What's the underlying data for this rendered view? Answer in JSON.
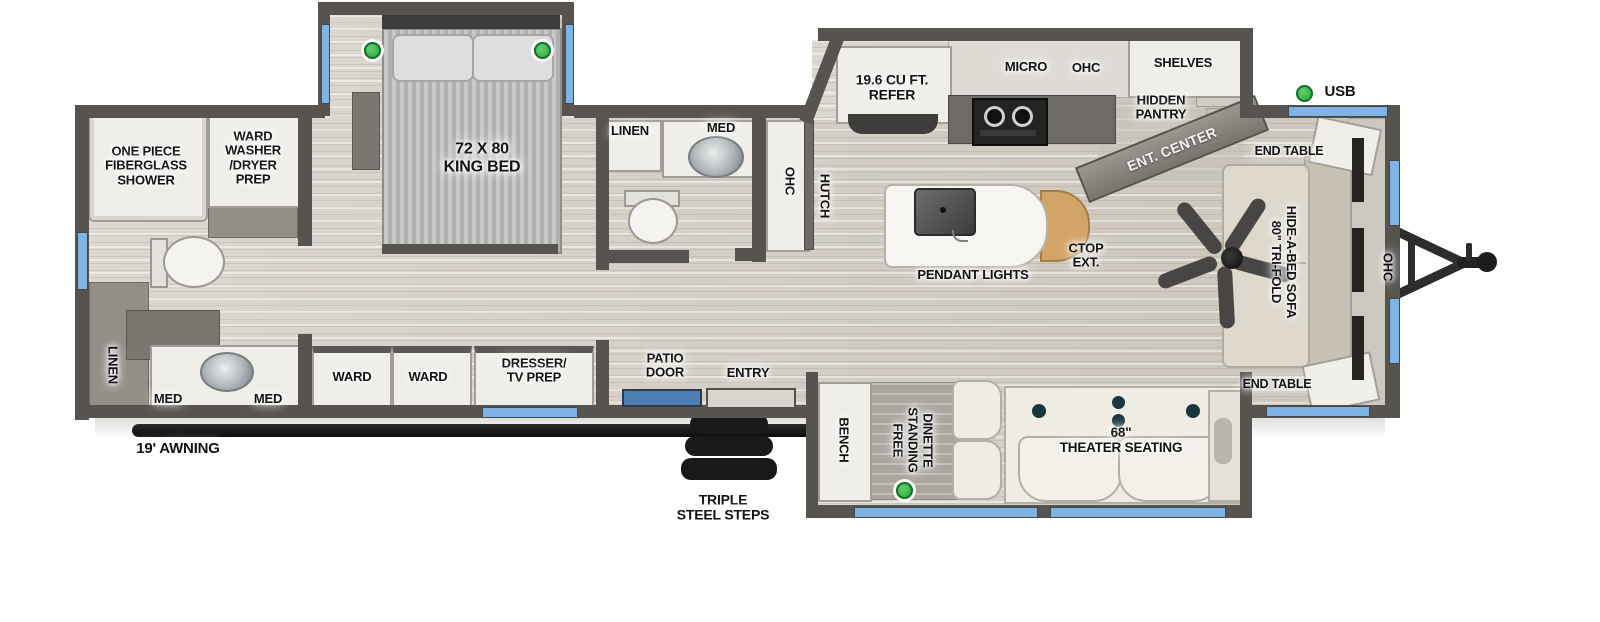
{
  "floorplan": {
    "rear_bath": {
      "shower": "ONE PIECE\nFIBERGLASS\nSHOWER",
      "ward_washer_dryer": "WARD\nWASHER\n/DRYER\nPREP",
      "linen": "LINEN",
      "med_left": "MED",
      "med_right": "MED"
    },
    "bedroom": {
      "king_bed": "72 X 80\nKING BED",
      "ward_left": "WARD",
      "ward_right": "WARD",
      "dresser_tv": "DRESSER/\nTV PREP"
    },
    "mid_bath": {
      "linen": "LINEN",
      "med": "MED"
    },
    "hallway": {
      "ohc": "OHC",
      "hutch": "HUTCH",
      "patio_door": "PATIO\nDOOR",
      "entry": "ENTRY"
    },
    "kitchen": {
      "refer": "19.6 CU FT.\nREFER",
      "micro": "MICRO",
      "ohc": "OHC",
      "shelves": "SHELVES",
      "hidden_pantry": "HIDDEN\nPANTRY",
      "ent_center": "ENT. CENTER",
      "ctop_ext": "CTOP\nEXT.",
      "pendant_lights": "PENDANT LIGHTS"
    },
    "dinette_slide": {
      "bench": "BENCH",
      "dinette": "FREE\nSTANDING\nDINETTE",
      "theater": "68\"\nTHEATER SEATING"
    },
    "front_living": {
      "end_table_top": "END TABLE",
      "sofa": "80\" TRI-FOLD\nHIDE-A-BED SOFA",
      "end_table_bottom": "END TABLE",
      "ohc": "OHC"
    },
    "exterior": {
      "awning": "19' AWNING",
      "steps": "TRIPLE\nSTEEL STEPS",
      "usb_legend": "USB"
    },
    "colors": {
      "wall": "#57534f",
      "floor": "#d5cfc5",
      "window_blue": "#7fb3e3",
      "usb_green": "#2da63e",
      "countertop_extension_wood": "#d2a366"
    }
  }
}
